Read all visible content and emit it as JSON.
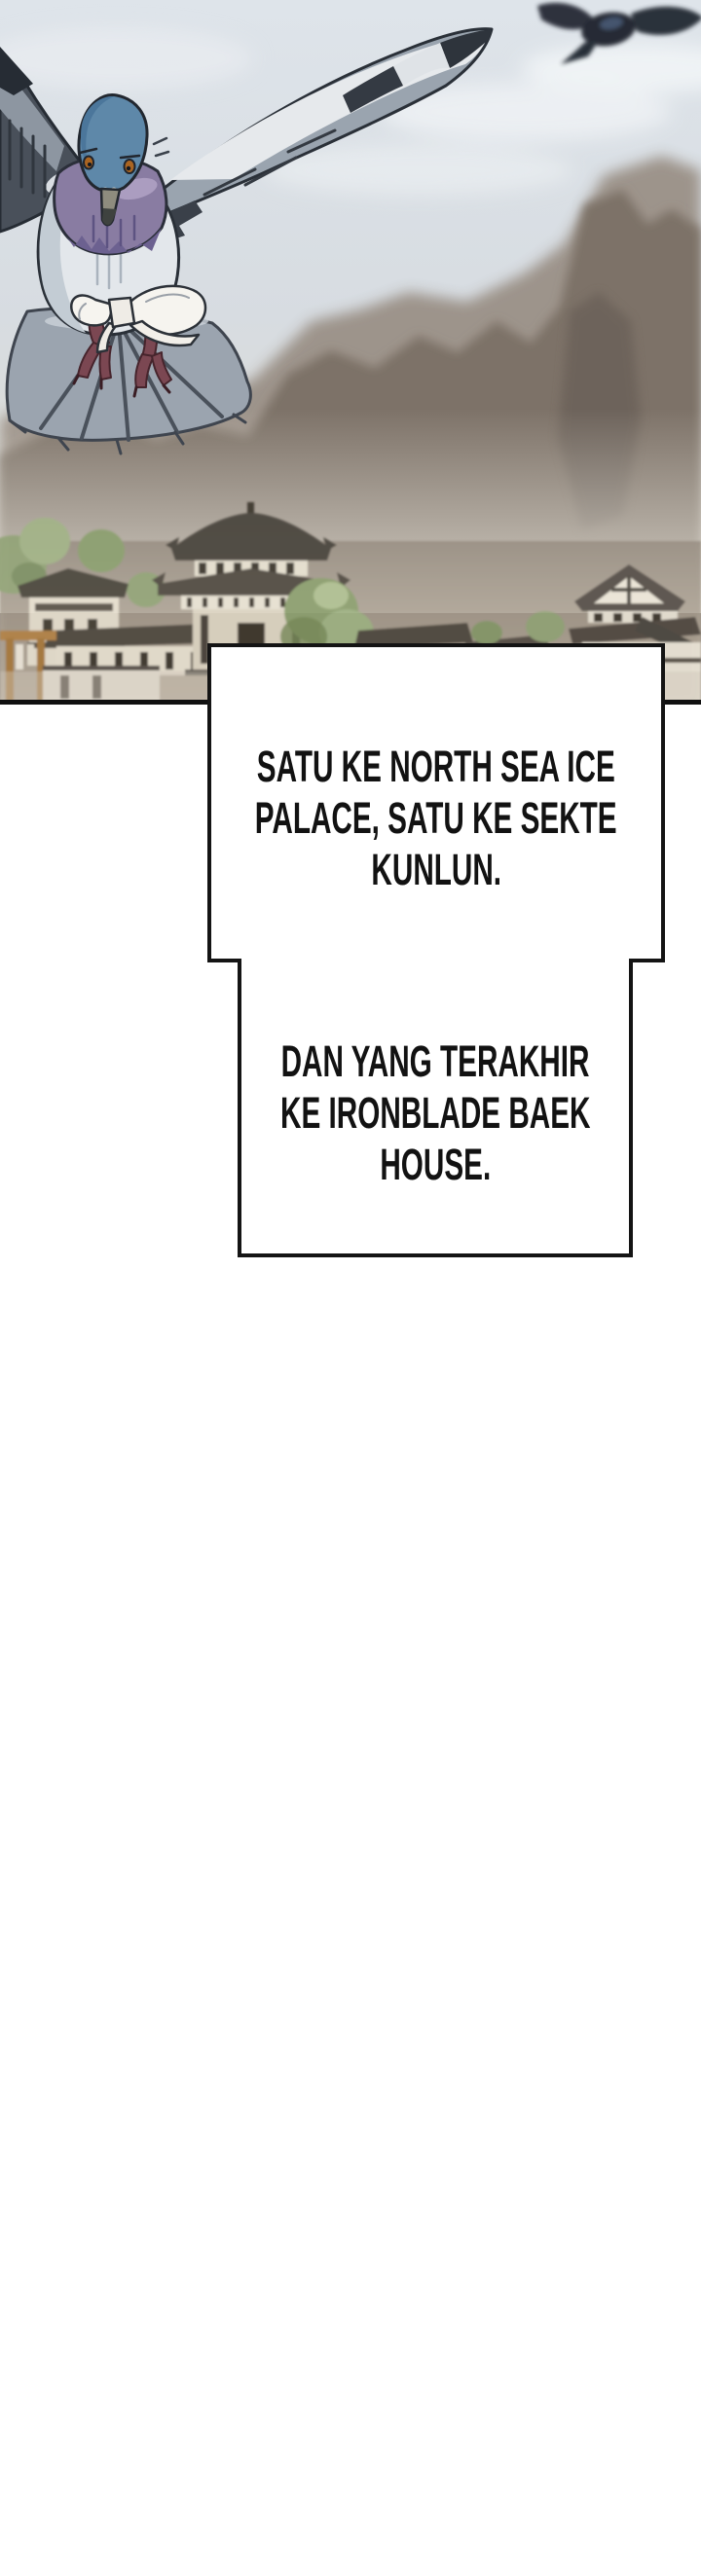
{
  "comic": {
    "bubbles": {
      "b1": {
        "lines": [
          "SATU KE NORTH SEA ICE",
          "PALACE, SATU KE SEKTE",
          "KUNLUN."
        ]
      },
      "b2": {
        "lines": [
          "DAN YANG TERAKHIR",
          "KE IRONBLADE BAEK",
          "HOUSE."
        ]
      }
    },
    "palette": {
      "background": "#ffffff",
      "bubble_fill": "#ffffff",
      "bubble_border": "#141414",
      "text_color": "#121212",
      "sky_top": "#dee4ea",
      "sky_horizon": "#e8e4db",
      "cloud": "#eef1f4",
      "mountain_far": "#9a9086",
      "mountain_near": "#7d7268",
      "mountain_dark": "#6b6158",
      "mist": "#e6e2d8",
      "village_haze": "#968c80",
      "roof_dark": "#4c463e",
      "wall_light": "#ece6d8",
      "tree_green": "#93a478",
      "tree_green_dark": "#75895c",
      "gate_orange": "#af7d42",
      "pigeon_head_blue": "#5e88a9",
      "pigeon_eye_orange": "#aa6522",
      "pigeon_neck_purple": "#897ca2",
      "pigeon_body_grey": "#e3e7eb",
      "pigeon_wing_grey": "#9aa4af",
      "pigeon_wing_dark": "#3a4049",
      "pigeon_feet_maroon": "#7b4752",
      "letter_white": "#f6f4ef",
      "distant_bird": "#2a303a",
      "panel_border": "#101010"
    }
  }
}
